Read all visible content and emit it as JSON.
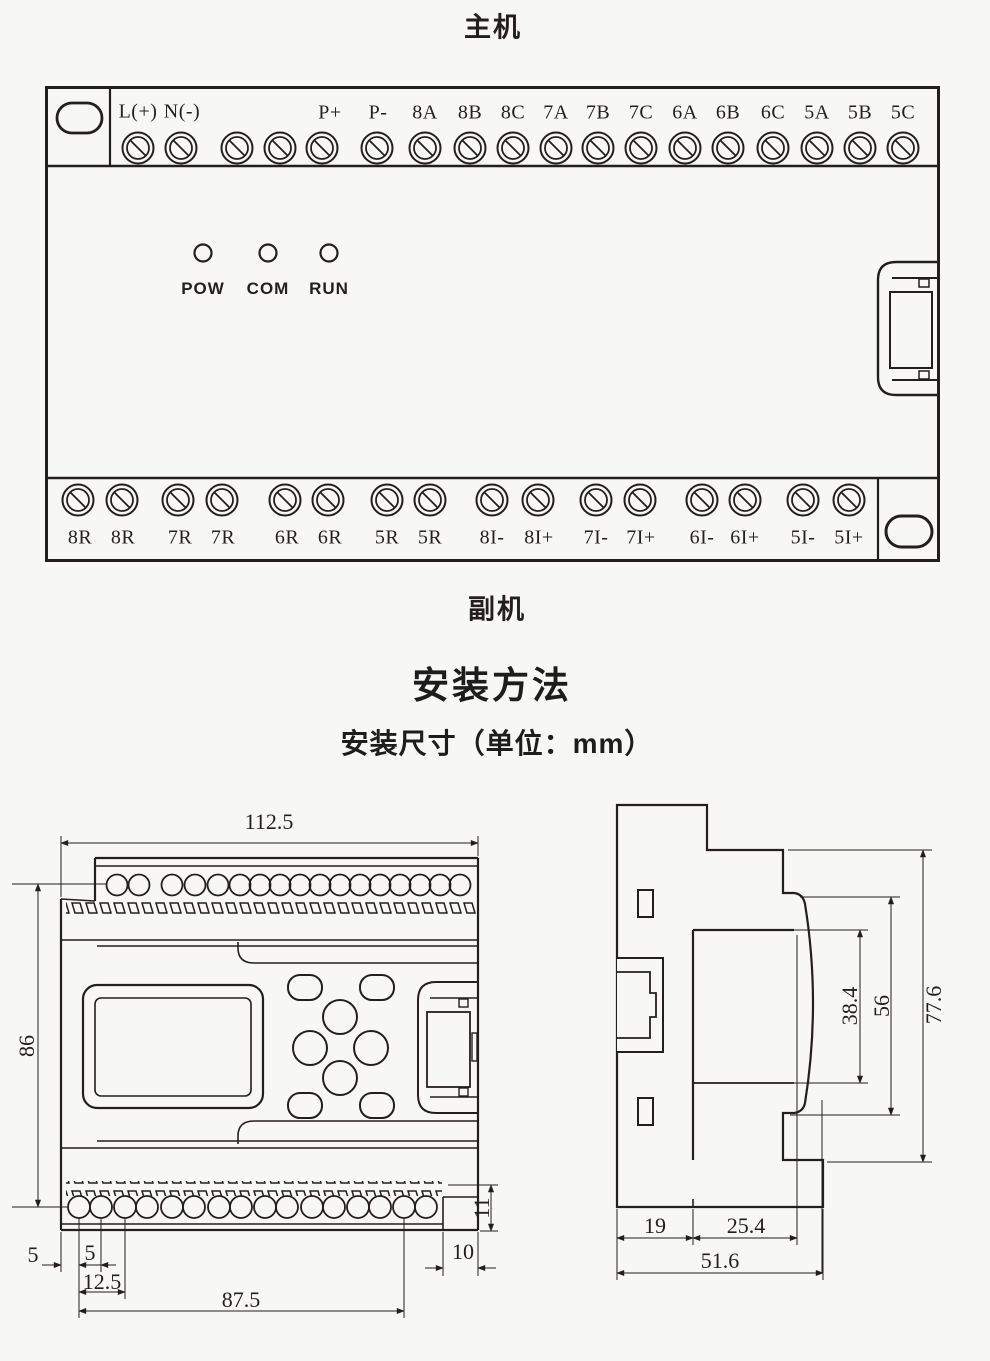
{
  "titles": {
    "main_unit": "主机",
    "secondary_unit": "副机",
    "install_method": "安装方法",
    "install_dims": "安装尺寸（单位：mm）"
  },
  "device": {
    "top_labels": [
      "L(+)",
      "N(-)",
      "P+",
      "P-",
      "8A",
      "8B",
      "8C",
      "7A",
      "7B",
      "7C",
      "6A",
      "6B",
      "6C",
      "5A",
      "5B",
      "5C"
    ],
    "leds": [
      "POW",
      "COM",
      "RUN"
    ],
    "bottom_labels": [
      "8R",
      "8R",
      "7R",
      "7R",
      "6R",
      "6R",
      "5R",
      "5R",
      "8I-",
      "8I+",
      "7I-",
      "7I+",
      "6I-",
      "6I+",
      "5I-",
      "5I+"
    ]
  },
  "front_view_dims": {
    "overall_width": "112.5",
    "overall_height": "86",
    "edge_to_hole": "5",
    "hole_pitch": "5",
    "hole_offset": "12.5",
    "hole_span": "87.5",
    "right_step": "10",
    "terminal_height": "11"
  },
  "side_view_dims": {
    "window_height": "38.4",
    "front_height": "56",
    "overall_height": "77.6",
    "rear_depth": "19",
    "mid_depth": "25.4",
    "overall_depth": "51.6"
  },
  "colors": {
    "line": "#231f1c",
    "background": "#f7f7f5"
  }
}
